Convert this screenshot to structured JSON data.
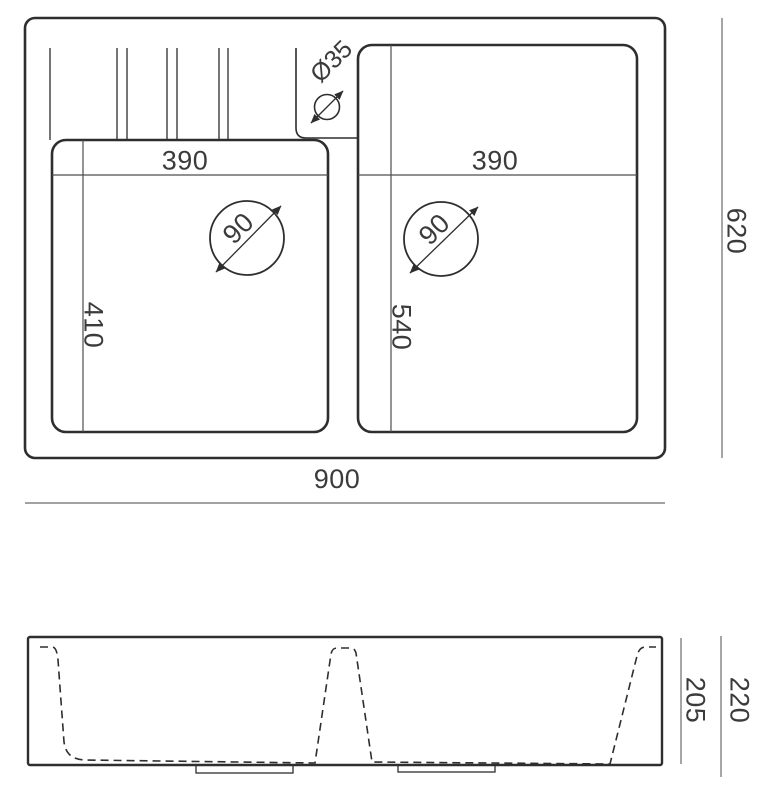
{
  "drawing": {
    "top_view": {
      "overall_width_label": "900",
      "overall_depth_label": "620",
      "left_bowl": {
        "width_label": "390",
        "depth_label": "410",
        "drain_diameter_label": "90"
      },
      "right_bowl": {
        "width_label": "390",
        "depth_label": "540",
        "drain_diameter_label": "90"
      },
      "faucet_hole_label": "Ø35"
    },
    "side_view": {
      "body_height_label": "205",
      "overall_height_label": "220"
    },
    "colors": {
      "outline": "#2e2e2e",
      "groove_line": "#3a3a3a",
      "inner_dimension_line": "#4d4d4d",
      "outer_dimension_line": "#6b6b6b",
      "text": "#3b3b3b",
      "background": "#ffffff"
    }
  }
}
